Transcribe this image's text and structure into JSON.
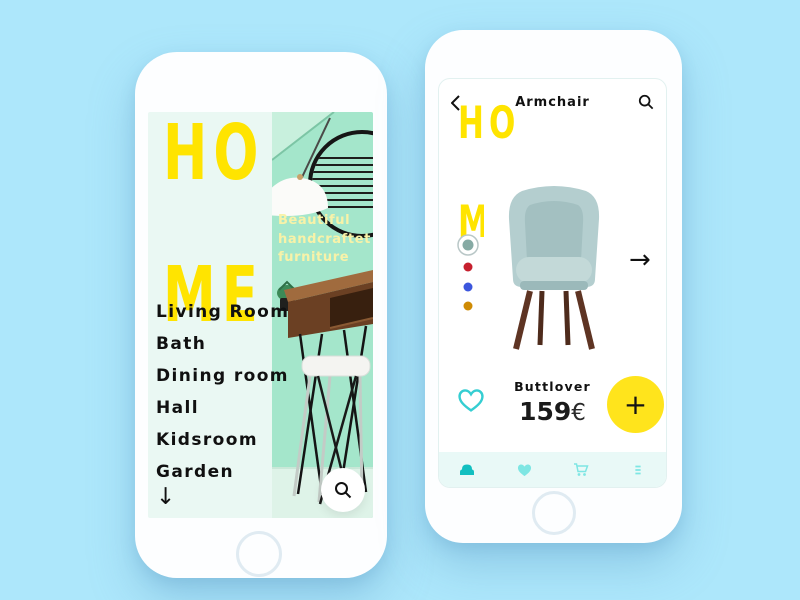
{
  "theme": {
    "background": "#ADE7FB",
    "accent_yellow": "#FFE400",
    "teal": "#2FCBCE",
    "screen_mint": "#EAF8F3",
    "photo_mint": "#A4E6CB"
  },
  "left_phone": {
    "brand": {
      "line1": "HO",
      "line2": "ME"
    },
    "tagline_lines": [
      "Beautiful",
      "handcraftet",
      "furniture"
    ],
    "menu_items": [
      {
        "label": "Living Room"
      },
      {
        "label": "Bath"
      },
      {
        "label": "Dining room"
      },
      {
        "label": "Hall"
      },
      {
        "label": "Kidsroom"
      },
      {
        "label": "Garden"
      }
    ],
    "scroll_down_glyph": "↓",
    "icons": {
      "search": "magnifier"
    }
  },
  "right_phone": {
    "header": {
      "title": "Armchair",
      "back_icon": "chevron-left",
      "search_icon": "magnifier"
    },
    "brand": {
      "line1": "HO",
      "line2": "ME"
    },
    "color_options": [
      {
        "name": "sage",
        "hex": "#86AAA4",
        "selected": true
      },
      {
        "name": "red",
        "hex": "#C6202E",
        "selected": false
      },
      {
        "name": "blue",
        "hex": "#3C56DD",
        "selected": false
      },
      {
        "name": "orange",
        "hex": "#CF8B04",
        "selected": false
      }
    ],
    "next_arrow_glyph": "→",
    "product": {
      "name": "Buttlover",
      "price_value": "159",
      "price_currency": "€"
    },
    "favorite_icon": "heart-outline",
    "add_button_glyph": "+",
    "tab_bar": {
      "items": [
        {
          "icon": "armchair",
          "active": true
        },
        {
          "icon": "heart",
          "active": false
        },
        {
          "icon": "cart",
          "active": false
        },
        {
          "icon": "menu",
          "active": false
        }
      ]
    }
  }
}
